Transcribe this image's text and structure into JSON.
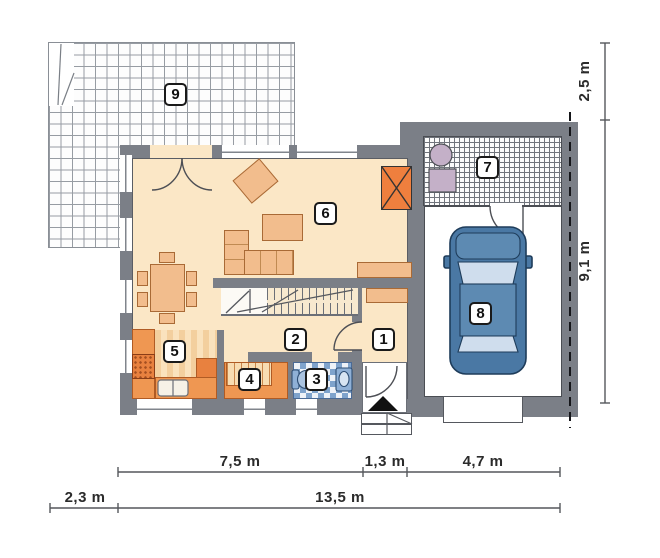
{
  "plan": {
    "type": "house-ground-floor-plan",
    "labels": {
      "r1": "1",
      "r2": "2",
      "r3": "3",
      "r4": "4",
      "r5": "5",
      "r6": "6",
      "r7": "7",
      "r8": "8",
      "r9": "9"
    },
    "rooms_semantics": {
      "r1": "vestibule",
      "r2": "hall",
      "r3": "bathroom",
      "r4": "pantry",
      "r5": "kitchen",
      "r6": "living-room",
      "r7": "utility-room",
      "r8": "garage",
      "r9": "terrace"
    },
    "dims": {
      "right_upper": "2,5 m",
      "right_lower": "9,1 m",
      "bottom_row1_left": "7,5 m",
      "bottom_row1_mid": "1,3 m",
      "bottom_row1_right": "4,7 m",
      "bottom_row2_left": "2,3 m",
      "bottom_row2_total": "13,5 m"
    },
    "colors": {
      "wall": "#7b7f87",
      "floor_cream": "#fbe7c6",
      "furniture": "#f2bd8d",
      "counter_orange": "#ef9752",
      "accent_orange": "#e8813f",
      "fireplace_orange": "#ef7f3e",
      "car_body": "#4a78a4",
      "bath_tile_blue": "#7fa3cc",
      "fixture_purple": "#c4b0c8"
    },
    "icons": {
      "entrance_marker": "triangle-up-icon"
    }
  }
}
